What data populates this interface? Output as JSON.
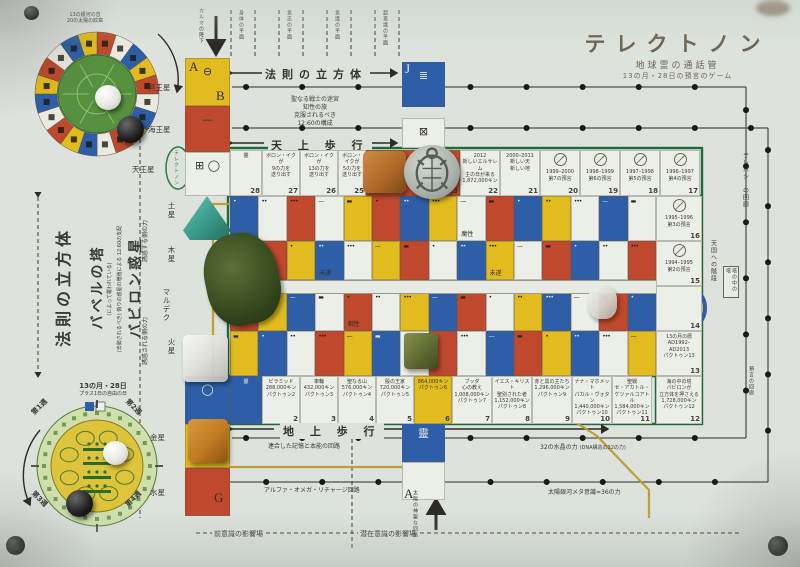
{
  "title": {
    "main": "テレクトノン",
    "sub1": "地球霊の通話管",
    "sub2": "13の月・28日の預言のゲーム"
  },
  "top_wheel": {
    "label1": "13の銀河の音",
    "label2": "20の太陽の紋章"
  },
  "bottom_wheel": {
    "label": "13の月・28日",
    "sublabel": "プラス1日の自由の日",
    "weeks": [
      "第1週",
      "第2週",
      "第3週",
      "第4週"
    ]
  },
  "planets_left_top": [
    "冥王星",
    "海王星",
    "天王星"
  ],
  "planets_left_mid": [
    "土星",
    "木星",
    "マルデク",
    "火星"
  ],
  "planets_left_bottom": [
    "金星",
    "水星"
  ],
  "left_texts": {
    "cube": "法則の立方体",
    "tower": "バベルの塔",
    "tower_note": "(によって覆われている)",
    "babylon": "バビロン惑星",
    "babylon_note1": "(去勢されるべき)",
    "babylon_note2": "偽りの惑星の増殖による",
    "babylon_note3": "12:60の支配",
    "force_top": "誘惑する側の力",
    "force_bottom": "誘惑される側の力",
    "karma": "カルマの降下"
  },
  "planes": [
    "身体の平面",
    "意志の平面",
    "意識の平面",
    "超意識の平面"
  ],
  "top_band": {
    "cube_label": "法則の立方体",
    "maze": [
      "聖なる戦士の迷宮",
      "知性の旅",
      "克服されるべき",
      "12:60の構成"
    ],
    "heaven_walk": "天 上 歩 行"
  },
  "start_oval": "テレクトノン",
  "letters": {
    "a_top": "A",
    "b_top": "B",
    "j": "J",
    "g": "G",
    "a_bottom": "A"
  },
  "track_top": [
    {
      "num": "28",
      "color": "W",
      "lines": [
        "靈"
      ]
    },
    {
      "num": "27",
      "color": "W",
      "lines": [
        "ボロン・イクが",
        "9の力を",
        "送り出す"
      ]
    },
    {
      "num": "26",
      "color": "W",
      "lines": [
        "ボロン・イクが",
        "13の力を",
        "送り出す"
      ]
    },
    {
      "num": "25",
      "color": "W",
      "lines": [
        "ボロン・イクが",
        "5の力を",
        "送り出す"
      ]
    },
    {
      "num": "24",
      "color": "R",
      "lines": []
    },
    {
      "num": "23",
      "color": "R",
      "lines": []
    },
    {
      "num": "22",
      "color": "W",
      "lines": [
        "2012",
        "新しいエルサレム",
        "主の日が来る",
        "1,872,000キン"
      ]
    },
    {
      "num": "21",
      "color": "W",
      "lines": [
        "2000–2011",
        "新しい天",
        "新しい地"
      ]
    },
    {
      "num": "20",
      "color": "W",
      "glyph": true,
      "lines": [
        "1999–2000",
        "第7の預言"
      ]
    },
    {
      "num": "19",
      "color": "W",
      "glyph": true,
      "lines": [
        "1998–1999",
        "第6の預言"
      ]
    },
    {
      "num": "18",
      "color": "W",
      "glyph": true,
      "lines": [
        "1997–1998",
        "第5の預言"
      ]
    },
    {
      "num": "17",
      "color": "W",
      "glyph": true,
      "lines": [
        "1996–1997",
        "第4の預言"
      ]
    }
  ],
  "track_right": [
    {
      "num": "16",
      "glyph": true,
      "lines": [
        "1995–1996",
        "第3の預言"
      ]
    },
    {
      "num": "15",
      "glyph": true,
      "lines": [
        "1994–1995",
        "第2の預言"
      ]
    },
    {
      "num": "14",
      "lines": []
    },
    {
      "num": "13",
      "lines": [
        "13の月の暦",
        "AD1992–AD2013",
        "パクトゥン13"
      ]
    },
    {
      "num": "12",
      "lines": [
        "海の中の塔",
        "バビロンが",
        "立方体を押さえる",
        "1,728,000キン",
        "パクトゥン12"
      ]
    }
  ],
  "track_bottom": [
    {
      "num": "",
      "color": "B",
      "lines": [
        "靈"
      ]
    },
    {
      "num": "2",
      "color": "W",
      "lines": [
        "ピラミッド",
        "288,000キン",
        "パクトゥン2"
      ]
    },
    {
      "num": "3",
      "color": "W",
      "lines": [
        "車輪",
        "432,000キン",
        "パクトゥン3"
      ]
    },
    {
      "num": "4",
      "color": "W",
      "lines": [
        "聖なる山",
        "576,000キン",
        "パクトゥン4"
      ]
    },
    {
      "num": "5",
      "color": "W",
      "lines": [
        "殷の王家",
        "720,000キン",
        "パクトゥン5"
      ]
    },
    {
      "num": "6",
      "color": "Y",
      "lines": [
        "864,000キン",
        "パクトゥン6"
      ]
    },
    {
      "num": "7",
      "color": "W",
      "lines": [
        "ブッダ",
        "心の教え",
        "1,008,000キン",
        "パクトゥン7"
      ]
    },
    {
      "num": "8",
      "color": "W",
      "lines": [
        "イエス・キリスト",
        "聖別された者",
        "1,152,000キン",
        "パクトゥン8"
      ]
    },
    {
      "num": "9",
      "color": "W",
      "lines": [
        "赤と黒の主たち",
        "1,296,000キン",
        "パクトゥン9"
      ]
    },
    {
      "num": "10",
      "color": "W",
      "lines": [
        "ナナ・マホメット",
        "パカル・ヴォタン",
        "1,440,000キン",
        "パクトゥン10"
      ]
    },
    {
      "num": "11",
      "color": "W",
      "lines": [
        "聖戦",
        "セ・アカトル・",
        "ケツァルコアトル",
        "1,584,000キン",
        "パクトゥン11"
      ]
    }
  ],
  "bottom_band": {
    "ground_walk": "地 上 歩 行",
    "circuit1": "連合した記憶と本能の回路",
    "circuit2": "アルファ・オメガ・リチャージ回路",
    "field_left": "前意識の影響場",
    "field_right": "潜在意識の影響場",
    "crystal": "32の水晶の力",
    "crystal_note": "(DNA構造の32の力)",
    "meta": "太陽銀河メタ意識=36の力",
    "solar_circuit": "太陽の神聖な回路"
  },
  "right_side": {
    "corridor": "テレパシーの回廊",
    "stairs": "天国への階段",
    "box": "塔の中の塔",
    "prophecy": "預言の回廊"
  },
  "grid": {
    "colors": [
      [
        "B",
        "W",
        "R",
        "W",
        "Y",
        "R",
        "B",
        "Y",
        "W",
        "R",
        "B",
        "Y",
        "W",
        "B",
        "W"
      ],
      [
        "W",
        "R",
        "Y",
        "B",
        "W",
        "Y",
        "R",
        "W",
        "B",
        "Y",
        "W",
        "R",
        "B",
        "W",
        "R"
      ],
      [
        "R",
        "Y",
        "B",
        "W",
        "R",
        "W",
        "Y",
        "B",
        "R",
        "W",
        "Y",
        "B",
        "W",
        "R",
        "B"
      ],
      [
        "Y",
        "B",
        "W",
        "R",
        "Y",
        "B",
        "W",
        "R",
        "W",
        "B",
        "R",
        "Y",
        "B",
        "W",
        "Y"
      ]
    ],
    "cell_labels": [
      {
        "r": 0,
        "c": 8,
        "t": "魔性"
      },
      {
        "r": 1,
        "c": 3,
        "t": "未遂"
      },
      {
        "r": 1,
        "c": 9,
        "t": "未遂"
      },
      {
        "r": 2,
        "c": 4,
        "t": "相性"
      }
    ]
  },
  "colors": {
    "R": "#c0482c",
    "B": "#2e5ea8",
    "Y": "#e2bb1e",
    "W": "#eceee8",
    "frame": "#1d6b38",
    "path": "#c19a2b",
    "title": "#6f6452"
  }
}
